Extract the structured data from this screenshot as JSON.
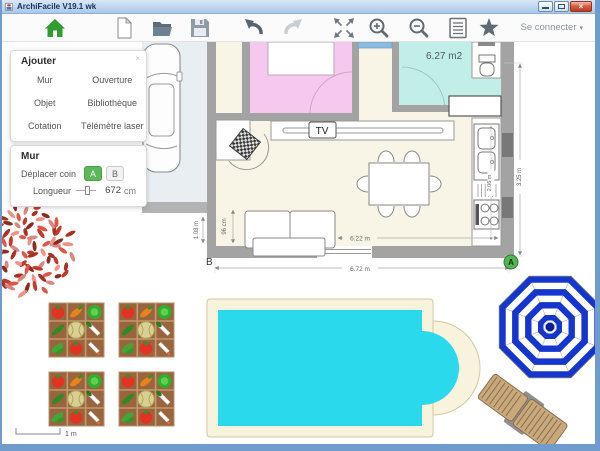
{
  "window": {
    "title": "ArchiFacile V19.1 wk"
  },
  "toolbar": {
    "connect_label": "Se connecter",
    "icons": [
      "home",
      "new-document",
      "open-folder",
      "save",
      "undo",
      "redo",
      "fit-screen",
      "zoom-in",
      "zoom-out",
      "plan-list",
      "favorites"
    ]
  },
  "add_panel": {
    "title": "Ajouter",
    "close_icon": "×",
    "buttons": [
      "Mur",
      "Ouverture",
      "Objet",
      "Bibliothèque",
      "Cotation",
      "Télémètre laser"
    ]
  },
  "wall_panel": {
    "title": "Mur",
    "move_corner_label": "Déplacer coin",
    "corner_buttons": [
      "A",
      "B"
    ],
    "length_label": "Longueur",
    "length_value": "672",
    "length_unit": "cm"
  },
  "plan": {
    "bathroom_area": "6.27 m2",
    "tv_label": "TV",
    "dimensions": {
      "sofa_to_wall": "96 cm",
      "inner_width": "6.22 m",
      "left_segment": "1.08 m",
      "outer_width": "6.72 m",
      "kitchen_counter": "2.06 m",
      "right_side": "3.25 m"
    },
    "corner_markers": {
      "a": "A",
      "b": "B"
    }
  },
  "scale_bar": {
    "label": "1 m"
  },
  "colors": {
    "accent_green": "#5cb85c",
    "wall_gray": "#a3a3a3",
    "bedroom_pink": "#f7c8ef",
    "bathroom_teal": "#c2eee8",
    "floor_cream": "#f9f5e6",
    "pool_water": "#2bd9ec",
    "parasol_blue": "#1535cf",
    "close_red": "#bf3a20"
  }
}
